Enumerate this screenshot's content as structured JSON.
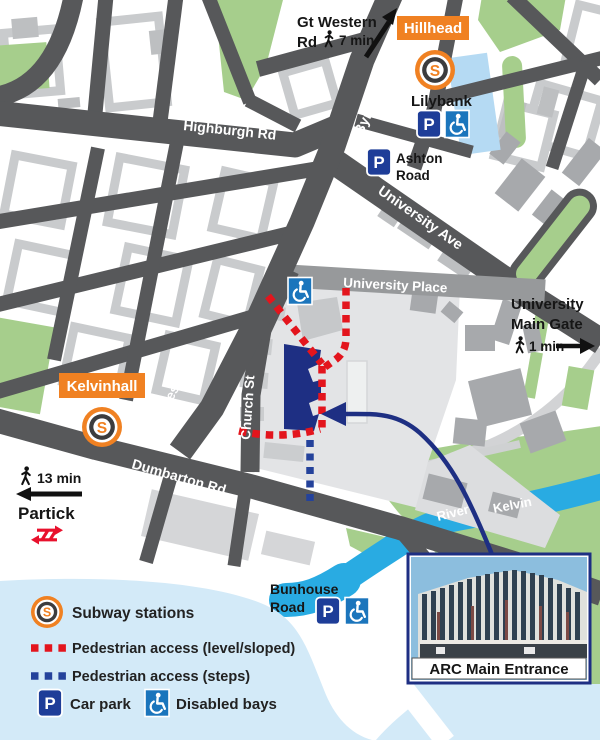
{
  "colors": {
    "road_dark": "#57585a",
    "road_medium": "#97999b",
    "green": "#a6ce8c",
    "river_blue": "#29abe2",
    "water_pale": "#d3eaf8",
    "orange": "#f08122",
    "navy": "#1e2f83",
    "access_red": "#e3151d",
    "steps_blue": "#24429b",
    "sign_blue": "#1b75bc",
    "parking_navy": "#1e3d98",
    "rail_red": "#e8112d",
    "site_gray": "#e3e4e6"
  },
  "stations": {
    "hillhead": "Hillhead",
    "kelvinhall": "Kelvinhall",
    "glyph": "S"
  },
  "roads": {
    "byres_top": "Byres Rd",
    "byres_bottom": "Byres Rd",
    "highburgh": "Highburgh Rd",
    "university_ave": "University Ave",
    "university_place": "University Place",
    "church": "Church St",
    "dumbarton": "Dumbarton Rd"
  },
  "places": {
    "lilybank": "Lilybank",
    "ashton_1": "Ashton",
    "ashton_2": "Road",
    "bunhouse_1": "Bunhouse",
    "bunhouse_2": "Road",
    "river_1": "River",
    "river_2": "Kelvin",
    "gt_western_1": "Gt Western",
    "gt_western_2": "Rd",
    "gt_western_time": "7 min",
    "main_gate_1": "University",
    "main_gate_2": "Main Gate",
    "main_gate_time": "1 min",
    "partick": "Partick",
    "partick_time": "13 min"
  },
  "photo": {
    "caption": "ARC Main Entrance"
  },
  "legend": {
    "subway": "Subway stations",
    "level": "Pedestrian access (level/sloped)",
    "steps": "Pedestrian access (steps)",
    "car_park": "Car park",
    "disabled": "Disabled bays",
    "parking_glyph": "P"
  }
}
